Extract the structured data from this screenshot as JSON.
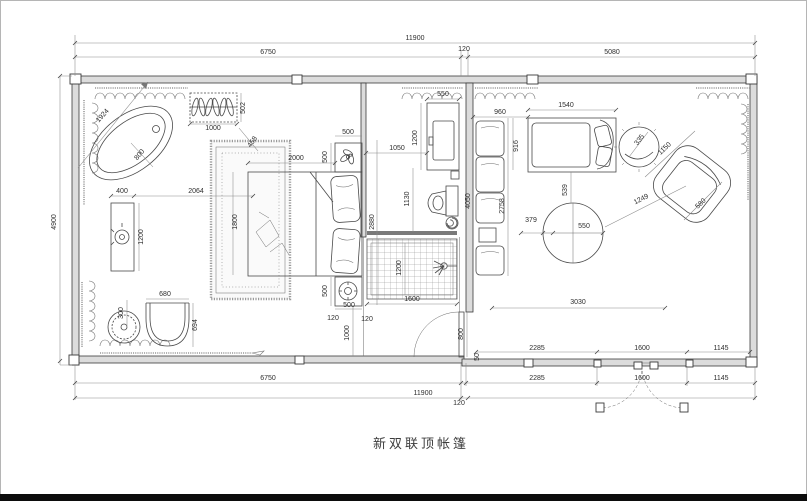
{
  "caption": "新双联顶帐篷",
  "colors": {
    "background": "#ffffff",
    "line": "#4a4a4a",
    "wall_fill": "#dcdcdc",
    "dim_text": "#2e2e2e",
    "screen_bar": "#7a7a7a",
    "bottom_bar": "#0c0c0c",
    "frame": "#b5b5b5"
  },
  "icons": {
    "plant-icon": "potted plant on nightstand",
    "tray-icon": "round tray on nightstand",
    "shower-icon": "shower spray head",
    "floor-drain-icon": "floor drain spiral",
    "hanger-rack-icon": "clothes hangers on rack",
    "door-swing-icon": "door swing arc",
    "double-door-icon": "double entry door with swing arcs"
  },
  "dim_labels": [
    {
      "text": "11900",
      "x": 415,
      "y": 40,
      "rot": 0
    },
    {
      "text": "6750",
      "x": 268,
      "y": 54,
      "rot": 0
    },
    {
      "text": "120",
      "x": 464,
      "y": 51,
      "rot": 0
    },
    {
      "text": "5080",
      "x": 612,
      "y": 54,
      "rot": 0
    },
    {
      "text": "4900",
      "x": 56,
      "y": 222,
      "rot": -90
    },
    {
      "text": "2285",
      "x": 537,
      "y": 350,
      "rot": 0
    },
    {
      "text": "1600",
      "x": 642,
      "y": 350,
      "rot": 0
    },
    {
      "text": "1145",
      "x": 721,
      "y": 350,
      "rot": 0
    },
    {
      "text": "6750",
      "x": 268,
      "y": 380,
      "rot": 0
    },
    {
      "text": "2285",
      "x": 537,
      "y": 380,
      "rot": 0
    },
    {
      "text": "1600",
      "x": 642,
      "y": 380,
      "rot": 0
    },
    {
      "text": "1145",
      "x": 721,
      "y": 380,
      "rot": 0
    },
    {
      "text": "11900",
      "x": 423,
      "y": 395,
      "rot": 0
    },
    {
      "text": "120",
      "x": 459,
      "y": 405,
      "rot": 0
    },
    {
      "text": "1924",
      "x": 104,
      "y": 117,
      "rot": -48
    },
    {
      "text": "800",
      "x": 141,
      "y": 156,
      "rot": -50
    },
    {
      "text": "1000",
      "x": 213,
      "y": 130,
      "rot": 0
    },
    {
      "text": "502",
      "x": 245,
      "y": 108,
      "rot": -90
    },
    {
      "text": "458",
      "x": 254,
      "y": 143,
      "rot": -55
    },
    {
      "text": "400",
      "x": 122,
      "y": 193,
      "rot": 0
    },
    {
      "text": "2064",
      "x": 196,
      "y": 193,
      "rot": 0
    },
    {
      "text": "1200",
      "x": 143,
      "y": 237,
      "rot": -90
    },
    {
      "text": "300",
      "x": 123,
      "y": 313,
      "rot": -90
    },
    {
      "text": "680",
      "x": 165,
      "y": 296,
      "rot": 0
    },
    {
      "text": "694",
      "x": 197,
      "y": 325,
      "rot": -90
    },
    {
      "text": "1800",
      "x": 237,
      "y": 222,
      "rot": -90
    },
    {
      "text": "2000",
      "x": 296,
      "y": 160,
      "rot": 0
    },
    {
      "text": "500",
      "x": 348,
      "y": 134,
      "rot": 0
    },
    {
      "text": "500",
      "x": 327,
      "y": 157,
      "rot": -90
    },
    {
      "text": "500",
      "x": 327,
      "y": 291,
      "rot": -90
    },
    {
      "text": "500",
      "x": 349,
      "y": 307,
      "rot": 0
    },
    {
      "text": "120",
      "x": 333,
      "y": 320,
      "rot": 0
    },
    {
      "text": "120",
      "x": 367,
      "y": 321,
      "rot": 0
    },
    {
      "text": "1000",
      "x": 349,
      "y": 333,
      "rot": -90
    },
    {
      "text": "550",
      "x": 443,
      "y": 96,
      "rot": 0
    },
    {
      "text": "1200",
      "x": 417,
      "y": 138,
      "rot": -90
    },
    {
      "text": "1050",
      "x": 397,
      "y": 150,
      "rot": 0
    },
    {
      "text": "1130",
      "x": 409,
      "y": 199,
      "rot": -90
    },
    {
      "text": "2880",
      "x": 374,
      "y": 222,
      "rot": -90
    },
    {
      "text": "1600",
      "x": 412,
      "y": 301,
      "rot": 0
    },
    {
      "text": "1200",
      "x": 401,
      "y": 268,
      "rot": -90
    },
    {
      "text": "800",
      "x": 463,
      "y": 334,
      "rot": -90
    },
    {
      "text": "50",
      "x": 479,
      "y": 357,
      "rot": -90
    },
    {
      "text": "4050",
      "x": 470,
      "y": 201,
      "rot": -90
    },
    {
      "text": "960",
      "x": 500,
      "y": 114,
      "rot": 0
    },
    {
      "text": "1540",
      "x": 566,
      "y": 107,
      "rot": 0
    },
    {
      "text": "916",
      "x": 518,
      "y": 146,
      "rot": -90
    },
    {
      "text": "2758",
      "x": 504,
      "y": 206,
      "rot": -90
    },
    {
      "text": "539",
      "x": 567,
      "y": 190,
      "rot": -90
    },
    {
      "text": "550",
      "x": 584,
      "y": 228,
      "rot": 0
    },
    {
      "text": "379",
      "x": 531,
      "y": 222,
      "rot": 0
    },
    {
      "text": "3030",
      "x": 578,
      "y": 304,
      "rot": 0
    },
    {
      "text": "335",
      "x": 641,
      "y": 141,
      "rot": -53
    },
    {
      "text": "1150",
      "x": 666,
      "y": 150,
      "rot": -43
    },
    {
      "text": "1249",
      "x": 642,
      "y": 201,
      "rot": -27
    },
    {
      "text": "580",
      "x": 702,
      "y": 205,
      "rot": -43
    }
  ]
}
